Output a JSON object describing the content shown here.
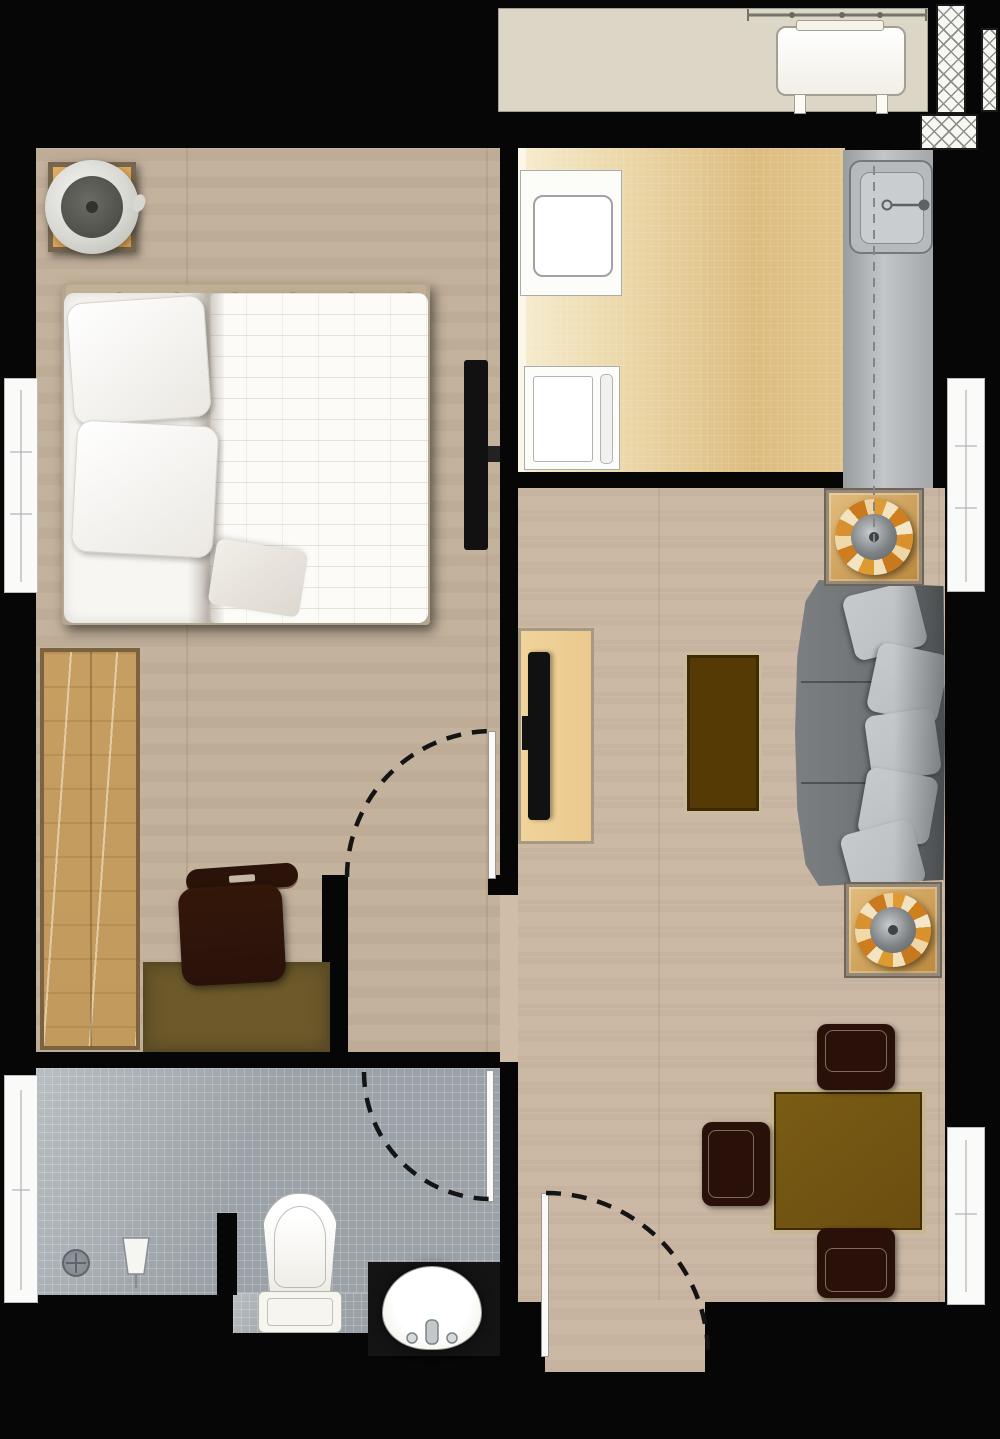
{
  "document": {
    "kind": "apartment-floor-plan",
    "view": "top-down",
    "text_labels": []
  },
  "palette": {
    "bg": "#060606",
    "wood-bed": "#c7b6a1",
    "wood-liv": "#cfbdaa",
    "kit-light": "#f6ecce",
    "kit-dark": "#ddbc80",
    "balcony": "#dbd6c5",
    "counter": "#aaaeb1",
    "tile": "#9aa1a7",
    "white": "#fafaf8",
    "wardrobe": "#c29a5d",
    "desk": "#6d5a2b",
    "chair-dark": "#2a120a",
    "table-brown": "#6b4e10",
    "table-frame": "#c6b691",
    "coffee": "#553a06",
    "console": "#ecc98e",
    "tv": "#111111",
    "sofa": "#6f7375",
    "pillow": "#b9bdbf",
    "plant-orange": "#d8912c",
    "plant-cream": "#f2e2c0",
    "plant-core": "#7d8285",
    "pot-fill": "#d8ab64",
    "nightstand": "#d9a055",
    "dash": "#141414"
  },
  "rooms": {
    "balcony": {
      "name": "balcony",
      "features": [
        "ac-condenser-unit",
        "railing"
      ]
    },
    "bedroom": {
      "name": "bedroom",
      "features": [
        "nightstand",
        "table-lamp",
        "double-bed",
        "two-pillows",
        "duvet",
        "wall-mounted-tv",
        "wardrobe",
        "desk",
        "desk-chair",
        "left-wall-window",
        "swing-door"
      ]
    },
    "kitchen": {
      "name": "kitchen",
      "features": [
        "fridge",
        "appliance",
        "counter-run",
        "sink-with-faucet",
        "upper-cabinet-dashed-line"
      ]
    },
    "living_room": {
      "name": "living-room",
      "features": [
        "tv-console",
        "tv",
        "coffee-table",
        "three-seat-sofa",
        "five-cushions",
        "plant-pot",
        "plant-pot",
        "right-wall-window"
      ]
    },
    "dining_area": {
      "name": "dining-area",
      "features": [
        "square-table",
        "three-chairs",
        "right-wall-window",
        "entry-door"
      ]
    },
    "bathroom": {
      "name": "bathroom",
      "features": [
        "shower-glass-panel",
        "shower-head",
        "floor-drain",
        "toilet",
        "oval-basin",
        "swing-door"
      ]
    }
  },
  "doors": [
    {
      "id": "bedroom-door",
      "type": "swing",
      "state": "shown-open-arc"
    },
    {
      "id": "bathroom-door",
      "type": "swing",
      "state": "shown-open-arc"
    },
    {
      "id": "entry-door",
      "type": "swing",
      "state": "shown-open-arc"
    }
  ],
  "windows": [
    {
      "id": "bedroom-window",
      "wall": "left"
    },
    {
      "id": "living-window",
      "wall": "right"
    },
    {
      "id": "dining-window",
      "wall": "right"
    }
  ]
}
